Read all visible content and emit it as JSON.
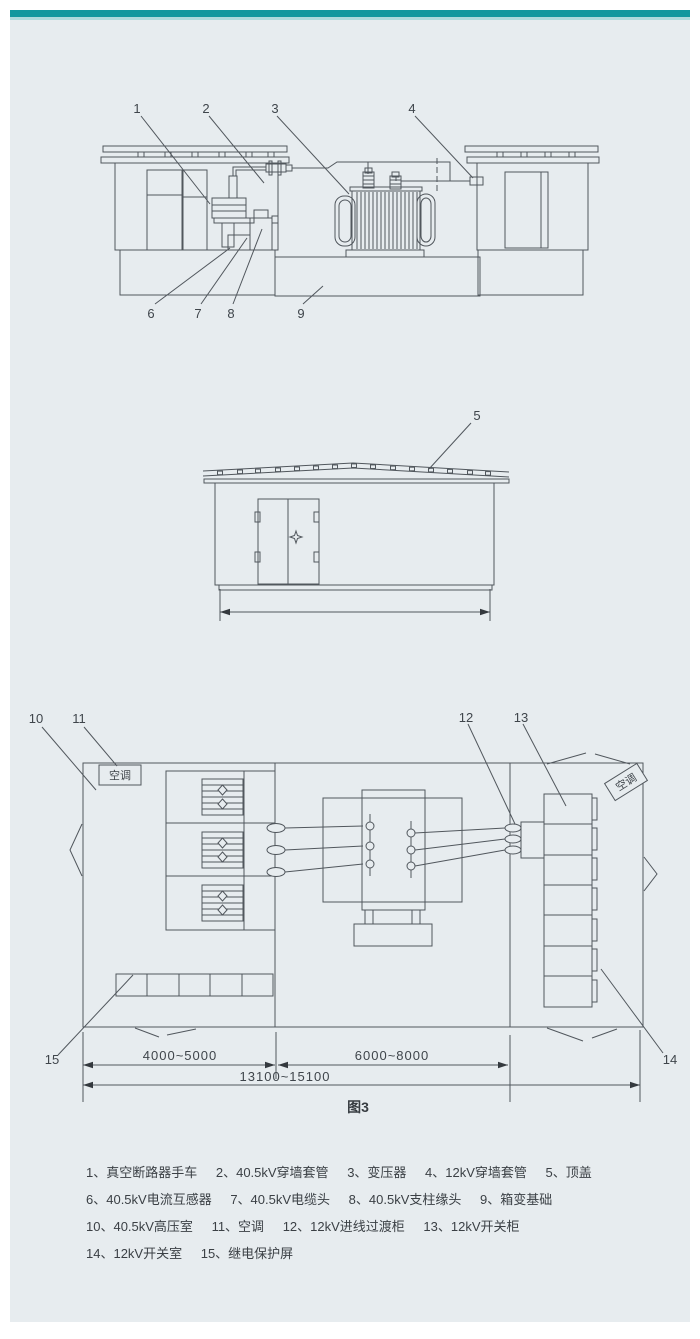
{
  "page": {
    "caption": "图3"
  },
  "colors": {
    "accent_teal": "#12979e",
    "accent_teal_light": "#aed9dc",
    "panel_background": "#e7ecef",
    "line_color": "#51575d",
    "text_color": "#3b4045"
  },
  "side_view": {
    "callouts": [
      "1",
      "2",
      "3",
      "4",
      "6",
      "7",
      "8",
      "9"
    ]
  },
  "end_view": {
    "callouts": [
      "5"
    ]
  },
  "plan_view": {
    "callouts": [
      "10",
      "11",
      "12",
      "13",
      "14",
      "15"
    ],
    "air_conditioner_left": "空调",
    "air_conditioner_right": "空调",
    "dimensions": {
      "left_room": "4000~5000",
      "transformer_room": "6000~8000",
      "overall": "13100~15100"
    }
  },
  "legend": {
    "lines": [
      [
        "1、真空断路器手车",
        "2、40.5kV穿墙套管",
        "3、变压器",
        "4、12kV穿墙套管",
        "5、顶盖"
      ],
      [
        "6、40.5kV电流互感器",
        "7、40.5kV电缆头",
        "8、40.5kV支柱缘头",
        "9、箱变基础"
      ],
      [
        "10、40.5kV高压室",
        "11、空调",
        "12、12kV进线过渡柜",
        "13、12kV开关柜"
      ],
      [
        "14、12kV开关室",
        "15、继电保护屏"
      ]
    ]
  }
}
